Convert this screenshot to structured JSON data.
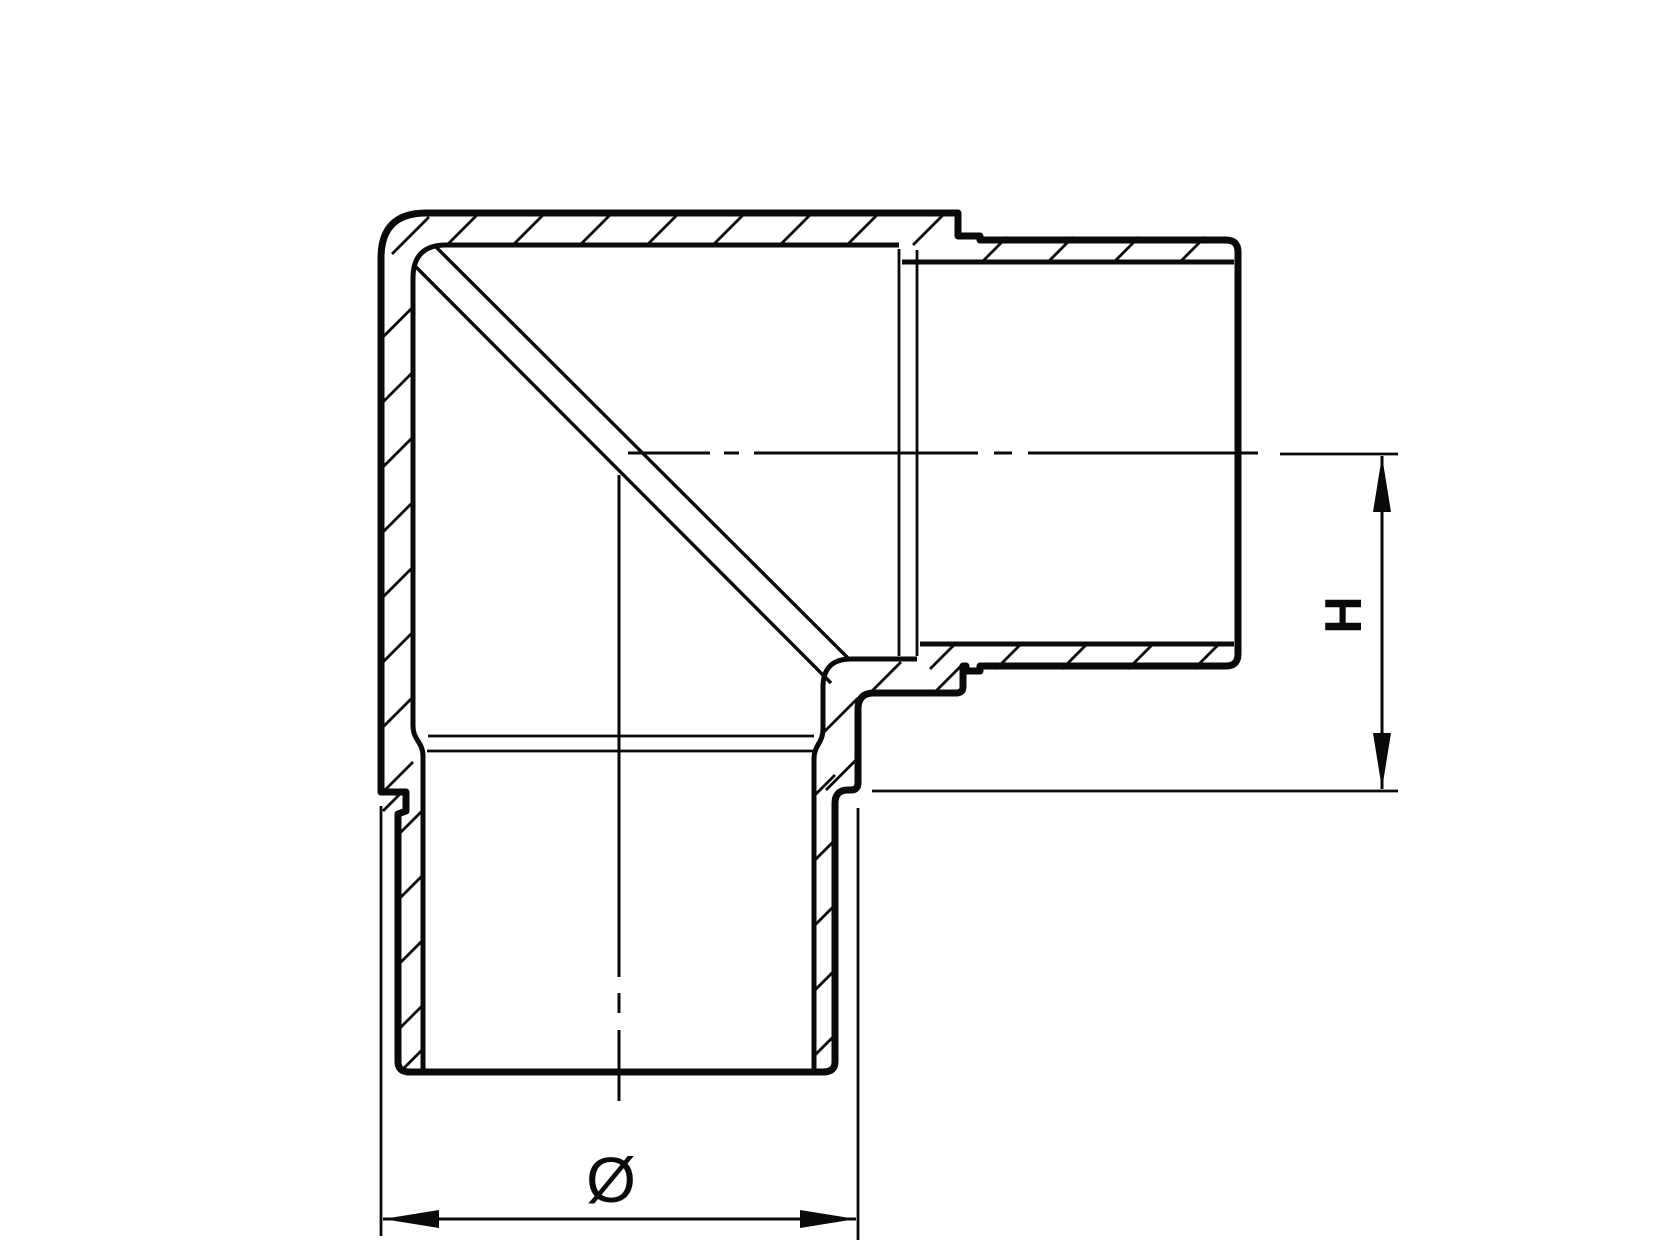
{
  "drawing": {
    "title": "Sectional technical drawing of a 90-degree elbow tube fitting",
    "view": "half-section with hatched cut walls",
    "dimension_labels": {
      "height": "H",
      "diameter": "Ø"
    },
    "colors": {
      "ink": "#0a0a0a",
      "paper": "#ffffff"
    }
  }
}
